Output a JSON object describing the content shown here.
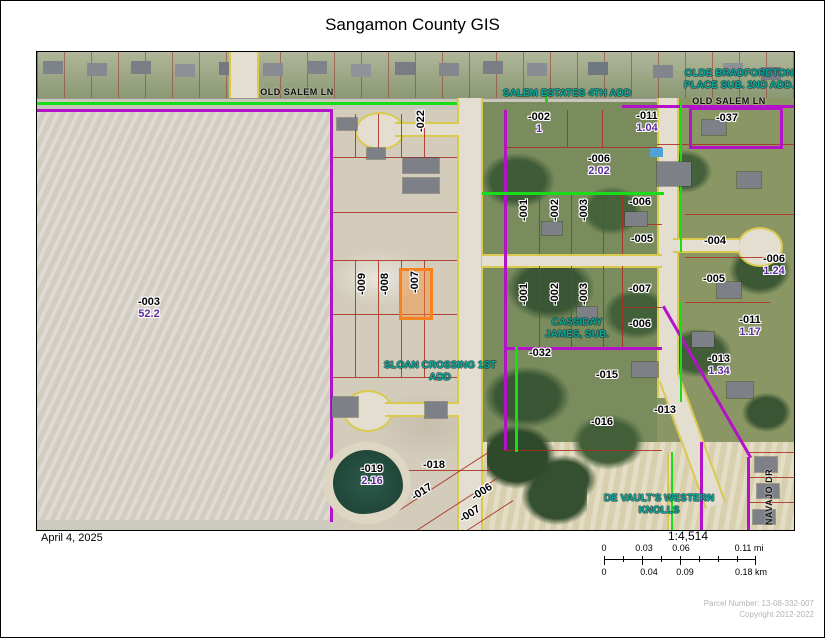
{
  "title": "Sangamon County GIS",
  "footer": {
    "date": "April 4, 2025",
    "parcel_number": "Parcel Number: 13-08-332-007",
    "copyright": "Copyright 2012-2022"
  },
  "scalebar": {
    "ratio": "1:4,514",
    "mi": [
      "0",
      "0.03",
      "0.06",
      "0.11 mi"
    ],
    "km": [
      "0",
      "0.04",
      "0.09",
      "0.18 km"
    ]
  },
  "colors": {
    "highlight": "#f5821f",
    "parcel_line_red": "#aa2d1e",
    "boundary_purple": "#b312c9",
    "boundary_green": "#18dd18",
    "road_edge_yellow": "#d9c94f",
    "subdivision_text": "#0aa89b",
    "acreage_text": "#5e2c9e"
  },
  "map": {
    "highlighted_parcel": "-007",
    "streets": [
      {
        "text": "OLD SALEM LN"
      },
      {
        "text": "OLD SALEM LN"
      },
      {
        "text": "NAVAJO DR"
      }
    ],
    "subdivisions": [
      {
        "line1": "SALEM ESTATES 4TH ADD",
        "line2": ""
      },
      {
        "line1": "OLDE BRADFORDTON",
        "line2": "PLACE SUB. 2ND ADD."
      },
      {
        "line1": "CASSIDAY",
        "line2": "JAMES, SUB."
      },
      {
        "line1": "SLOAN CROSSING 1ST",
        "line2": "ADD"
      },
      {
        "line1": "DE VAULT'S WESTERN",
        "line2": "KNOLLS"
      }
    ],
    "labels": [
      {
        "t": "-003",
        "a": "52.2"
      },
      {
        "t": "-022"
      },
      {
        "t": "-002",
        "a": "1"
      },
      {
        "t": "-011",
        "a": "1.04"
      },
      {
        "t": "-037"
      },
      {
        "t": "-006",
        "a": "2.02"
      },
      {
        "t": "-006"
      },
      {
        "t": "-005"
      },
      {
        "t": "-004"
      },
      {
        "t": "-005"
      },
      {
        "t": "-006",
        "a": "1.24"
      },
      {
        "t": "-007"
      },
      {
        "t": "-006"
      },
      {
        "t": "-011",
        "a": "1.17"
      },
      {
        "t": "-032"
      },
      {
        "t": "-013",
        "a": "1.34"
      },
      {
        "t": "-015"
      },
      {
        "t": "-013"
      },
      {
        "t": "-016"
      },
      {
        "t": "-019",
        "a": "2.16"
      },
      {
        "t": "-018"
      },
      {
        "t": "-017"
      },
      {
        "t": "-006"
      },
      {
        "t": "-007"
      },
      {
        "t": "-009"
      },
      {
        "t": "-008"
      },
      {
        "t": "-007"
      },
      {
        "t": "-001"
      },
      {
        "t": "-002"
      },
      {
        "t": "-003"
      },
      {
        "t": "-001"
      },
      {
        "t": "-002"
      },
      {
        "t": "-003"
      }
    ]
  }
}
